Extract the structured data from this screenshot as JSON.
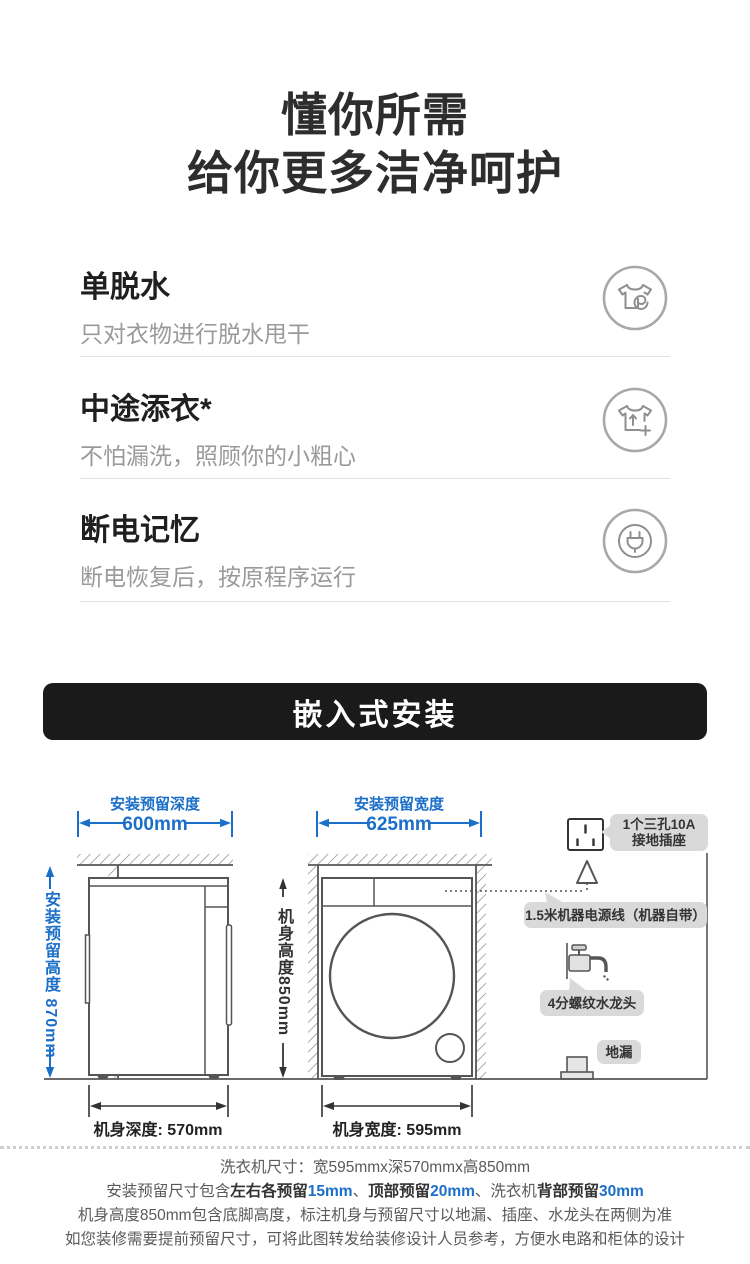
{
  "hero": {
    "line1": "懂你所需",
    "line2": "给你更多洁净呵护"
  },
  "features": [
    {
      "title": "单脱水",
      "desc": "只对衣物进行脱水甩干",
      "icon": "spin-dry-shirt-icon"
    },
    {
      "title": "中途添衣*",
      "desc": "不怕漏洗，照顾你的小粗心",
      "icon": "add-clothes-shirt-icon"
    },
    {
      "title": "断电记忆",
      "desc": "断电恢复后，按原程序运行",
      "icon": "power-plug-icon"
    }
  ],
  "banner": {
    "title": "嵌入式安装"
  },
  "diagram": {
    "reserve_depth_label": "安装预留深度",
    "reserve_depth_value": "600mm",
    "reserve_width_label": "安装预留宽度",
    "reserve_width_value": "625mm",
    "reserve_height_label": "安装预留高度 870mm",
    "body_height_label": "机身高度850mm",
    "body_depth_label": "机身深度: 570mm",
    "body_width_label": "机身宽度: 595mm",
    "socket_label_line1": "1个三孔10A",
    "socket_label_line2": "接地插座",
    "power_cord_label": "1.5米机器电源线（机器自带）",
    "faucet_label": "4分螺纹水龙头",
    "drain_label": "地漏",
    "icons": [
      "socket-icon",
      "plug-icon",
      "faucet-icon",
      "floor-drain-icon"
    ]
  },
  "notes": {
    "line1": "洗衣机尺寸：宽595mmx深570mmx高850mm",
    "line2_prefix": "安装预留尺寸包含",
    "line2_bold1": "左右各预留",
    "line2_value1": "15mm",
    "line2_sep1": "、",
    "line2_bold2": "顶部预留",
    "line2_value2": "20mm",
    "line2_sep2": "、",
    "line2_plain3": "洗衣机",
    "line2_bold3": "背部预留",
    "line2_value3": "30mm",
    "line3": "机身高度850mm包含底脚高度，标注机身与预留尺寸以地漏、插座、水龙头在两侧为准",
    "line4": "如您装修需要提前预留尺寸，可将此图转发给装修设计人员参考，方便水电路和柜体的设计"
  },
  "colors": {
    "accent_blue": "#1b6fc8",
    "banner_bg": "#1a1a1a",
    "bubble_bg": "#d9d9d9"
  }
}
